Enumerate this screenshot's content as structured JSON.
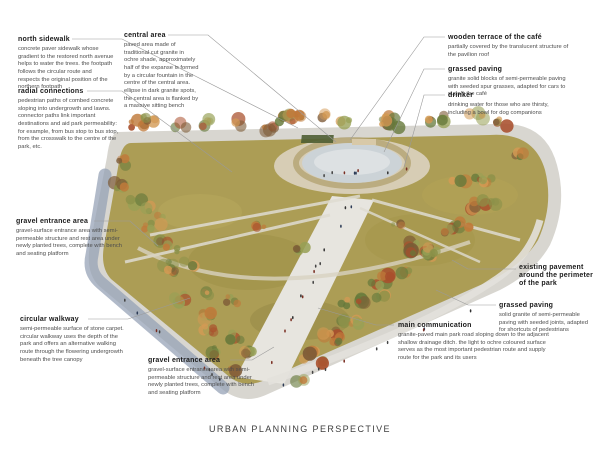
{
  "page": {
    "title": "URBAN PLANNING PERSPECTIVE"
  },
  "annotations": [
    {
      "key": "north-sidewalk",
      "title": "north sidewalk",
      "description": "concrete paver sidewalk whose gradient to the restored north avenue helps to water the trees. the footpath follows the circular route and respects the original position of the northern footpath"
    },
    {
      "key": "radial-connections",
      "title": "radial connections",
      "description": "pedestrian paths of combed concrete sloping into undergrowth and lawns. connector paths link important destinations and aid park permeability: for example, from bus stop to bus stop, from the crosswalk to the centre of the park, etc."
    },
    {
      "key": "central-area",
      "title": "central area",
      "description": "paved area made of traditional cut granite in ochre shade, approximately half of the expanse is formed by a circular fountain in the centre of the central area. ellipse in dark granite spots, the central area is flanked by a massive sitting bench"
    },
    {
      "key": "wooden-terrace-cafe",
      "title": "wooden terrace of the café",
      "description": "partially covered by the translucent structure of the pavilion roof"
    },
    {
      "key": "grassed-paving-cafe",
      "title": "grassed paving",
      "description": "granite solid blocks of semi-permeable paving with seeded spur grasses, adapted for cars to supply the café"
    },
    {
      "key": "drinker",
      "title": "drinker",
      "description": "drinking water for those who are thirsty, including a bowl for dog companions"
    },
    {
      "key": "gravel-entrance-west",
      "title": "gravel entrance area",
      "description": "gravel-surface entrance area with semi-permeable structure and rest area under newly planted trees, complete with bench and seating platform"
    },
    {
      "key": "circular-walkway",
      "title": "circular walkway",
      "description": "semi-permeable surface of stone carpet. circular walkway uses the depth of the park and offers an alternative walking route through the flowering undergrowth beneath the tree canopy"
    },
    {
      "key": "gravel-entrance-south",
      "title": "gravel entrance area",
      "description": "gravel-surface entrance area with semi-permeable structure and rest area under newly planted trees, complete with bench and seating platform"
    },
    {
      "key": "main-communication",
      "title": "main communication",
      "description": "granite-paved main park road sloping down to the adjacent shallow drainage ditch. the light to ochre coloured surface serves as the most important pedestrian route and supply route for the park and its users"
    },
    {
      "key": "existing-pavement",
      "title": "existing pavement around the perimeter of the park",
      "description": ""
    },
    {
      "key": "grassed-paving-perimeter",
      "title": "grassed paving",
      "description": "solid granite of semi-permeable paving with seeded joints, adapted for shortcuts of pedestrians"
    }
  ],
  "illustration": {
    "name": "urban-park-perspective-render",
    "colors": {
      "lawn": "#ac9d55",
      "lawn_dark": "#93853f",
      "path": "#e8e6e0",
      "sidewalk": "#d8d6d0",
      "sidewalk_shadow": "#93a0b4",
      "pond": "#ccd3d7",
      "tree_orange": "#c07a3a",
      "tree_red": "#a94f2c",
      "tree_olive": "#8b9149",
      "tree_green": "#66793b",
      "leader_line": "#9a9a9a"
    }
  }
}
